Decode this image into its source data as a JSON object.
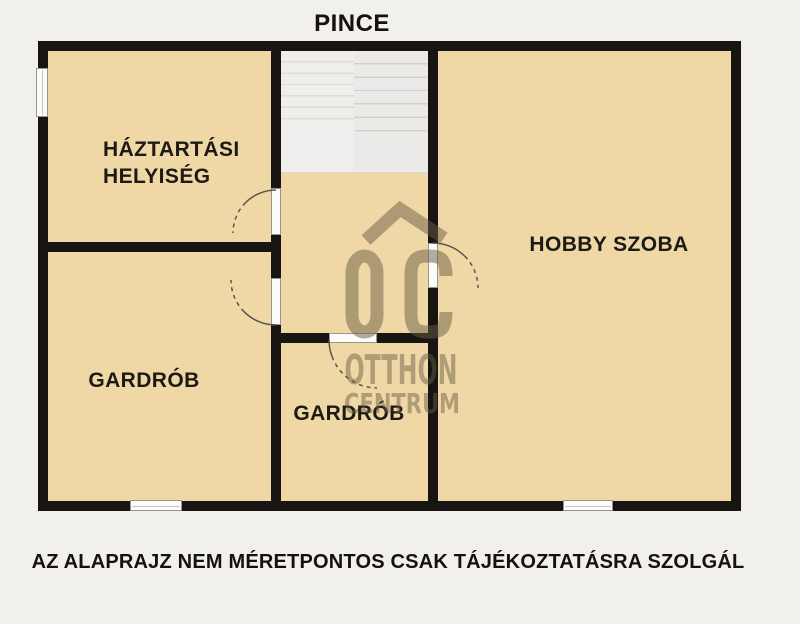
{
  "title": "PINCE",
  "disclaimer": "AZ ALAPRAJZ NEM MÉRETPONTOS CSAK TÁJÉKOZTATÁSRA SZOLGÁL",
  "rooms": {
    "haztartasi": {
      "line1": "HÁZTARTÁSI",
      "line2": "HELYISÉG"
    },
    "gardrob_left": {
      "label": "GARDRÓB"
    },
    "gardrob_middle": {
      "label": "GARDRÓB"
    },
    "hobby": {
      "label": "HOBBY SZOBA"
    }
  },
  "watermark": {
    "logo_text": "OC",
    "name_line1": "OTTHON",
    "name_line2": "CENTRUM"
  },
  "colors": {
    "background": "#f2f0ea",
    "room_fill": "#f0d8a6",
    "wall": "#171412",
    "stairs_fill": "#edecea",
    "watermark": "#675c44",
    "text": "#14110e"
  }
}
